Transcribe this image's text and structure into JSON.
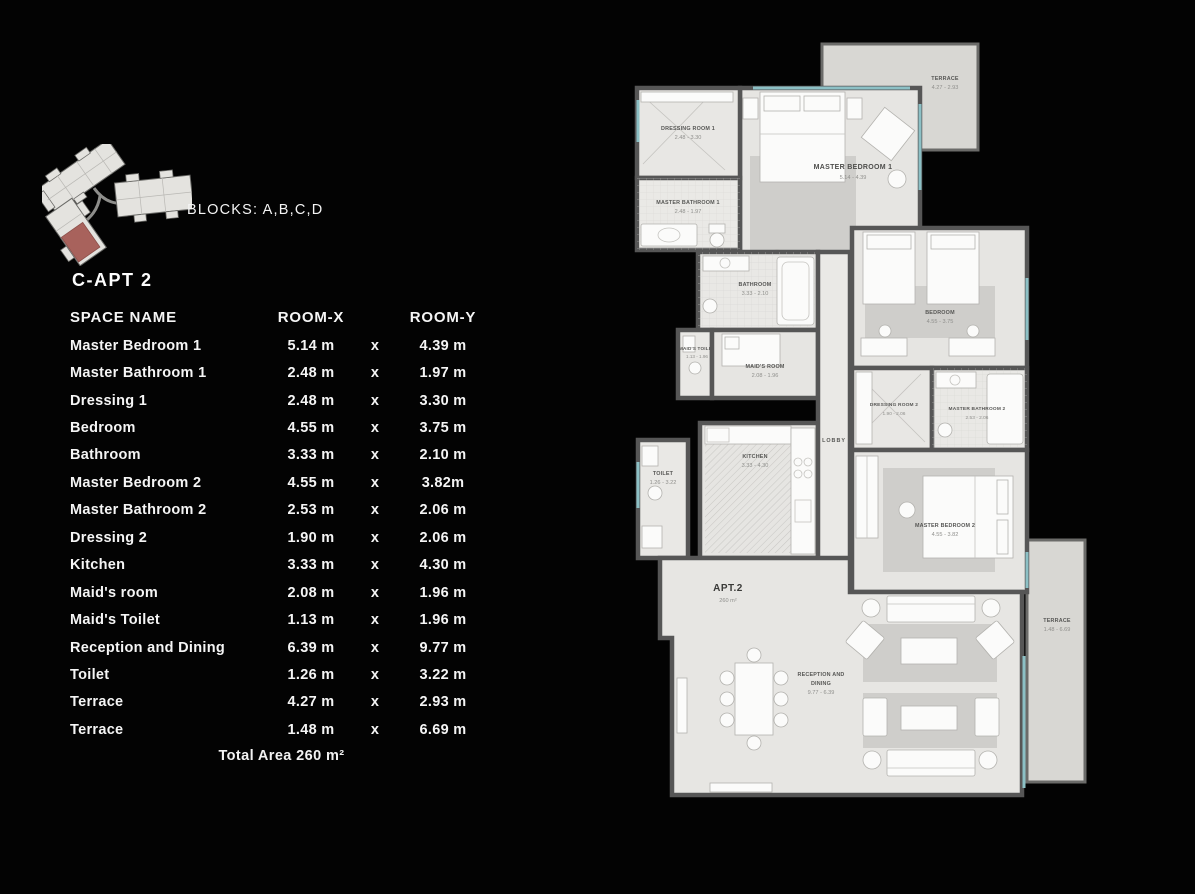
{
  "site": {
    "blocks_label": "BLOCKS: A,B,C,D"
  },
  "apt": {
    "title": "C-APT 2"
  },
  "table": {
    "headers": {
      "space": "SPACE NAME",
      "x": "ROOM-X",
      "y": "ROOM-Y"
    },
    "sep": "x",
    "rows": [
      {
        "space": "Master Bedroom 1",
        "x": "5.14 m",
        "y": "4.39 m"
      },
      {
        "space": "Master Bathroom 1",
        "x": "2.48 m",
        "y": "1.97 m"
      },
      {
        "space": "Dressing 1",
        "x": "2.48 m",
        "y": "3.30 m"
      },
      {
        "space": "Bedroom",
        "x": "4.55 m",
        "y": "3.75 m"
      },
      {
        "space": "Bathroom",
        "x": "3.33 m",
        "y": "2.10 m"
      },
      {
        "space": "Master Bedroom 2",
        "x": "4.55 m",
        "y": "3.82m"
      },
      {
        "space": "Master Bathroom 2",
        "x": "2.53 m",
        "y": "2.06 m"
      },
      {
        "space": "Dressing 2",
        "x": "1.90 m",
        "y": "2.06 m"
      },
      {
        "space": "Kitchen",
        "x": "3.33 m",
        "y": "4.30 m"
      },
      {
        "space": "Maid's room",
        "x": "2.08 m",
        "y": "1.96 m"
      },
      {
        "space": "Maid's Toilet",
        "x": "1.13 m",
        "y": "1.96 m"
      },
      {
        "space": "Reception and Dining",
        "x": "6.39 m",
        "y": "9.77 m"
      },
      {
        "space": "Toilet",
        "x": "1.26 m",
        "y": "3.22 m"
      },
      {
        "space": "Terrace",
        "x": "4.27 m",
        "y": "2.93 m"
      },
      {
        "space": "Terrace",
        "x": "1.48 m",
        "y": "6.69 m"
      }
    ],
    "total": "Total Area 260 m²"
  },
  "plan": {
    "apt": {
      "label": "APT.2",
      "area": "260 m²"
    },
    "rooms": {
      "terrace1": {
        "name": "TERRACE",
        "dims": "4.27 - 2.93"
      },
      "dressing1": {
        "name": "DRESSING ROOM 1",
        "dims": "2.48 - 3.30"
      },
      "masterbath1": {
        "name": "MASTER BATHROOM 1",
        "dims": "2.48 - 1.97"
      },
      "masterbed1": {
        "name": "MASTER BEDROOM 1",
        "dims": "5.14 - 4.39"
      },
      "bathroom": {
        "name": "BATHROOM",
        "dims": "3.33 - 2.10"
      },
      "maids_toilet": {
        "name": "MAID'S TOILET",
        "dims": "1.13 - 1.96"
      },
      "maids_room": {
        "name": "MAID'S ROOM",
        "dims": "2.08 - 1.96"
      },
      "kitchen": {
        "name": "KITCHEN",
        "dims": "3.33 - 4.30"
      },
      "toilet": {
        "name": "TOILET",
        "dims": "1.26 - 3.22"
      },
      "lobby": {
        "name": "LOBBY"
      },
      "bedroom": {
        "name": "BEDROOM",
        "dims": "4.55 - 3.75"
      },
      "dressing2": {
        "name": "DRESSING ROOM 2",
        "dims": "1.90 - 2.06"
      },
      "masterbath2": {
        "name": "MASTER BATHROOM 2",
        "dims": "2.53 - 2.06"
      },
      "masterbed2": {
        "name": "MASTER BEDROOM 2",
        "dims": "4.55 - 3.82"
      },
      "reception": {
        "line1": "RECEPTION AND",
        "line2": "DINING",
        "dims": "9.77 - 6.39"
      },
      "terrace2": {
        "name": "TERRACE",
        "dims": "1.48 - 6.69"
      }
    }
  },
  "colors": {
    "background": "#030303",
    "floor": "#e6e5e2",
    "wall": "#565656",
    "glass": "#8cc0c5",
    "highlight_unit": "#a8625c"
  }
}
